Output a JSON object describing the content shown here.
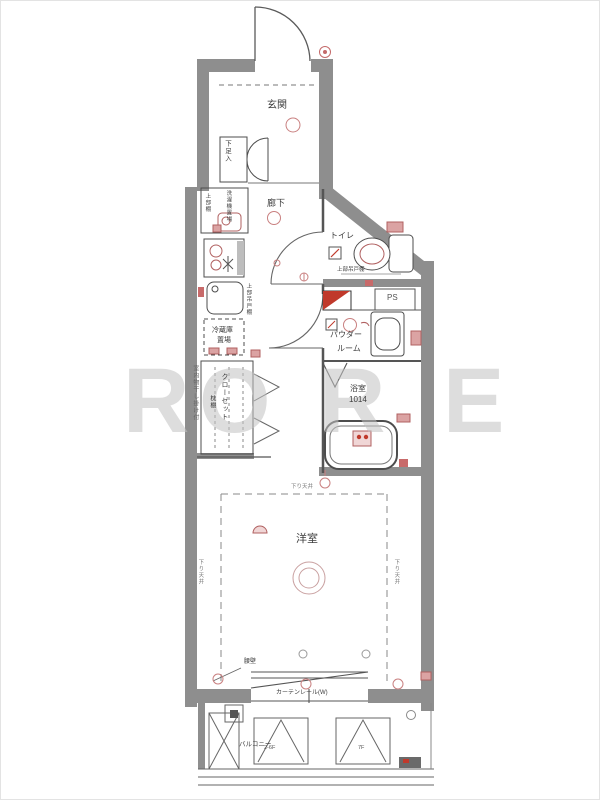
{
  "plan": {
    "entrance": {
      "label": "玄関"
    },
    "shoe_box": {
      "label": "下足入"
    },
    "hallway": {
      "label": "廊下"
    },
    "toilet": {
      "label": "トイレ",
      "upper_cabinet": "上部吊戸棚"
    },
    "ps": {
      "label": "PS"
    },
    "powder_room": {
      "line1": "パウダー",
      "line2": "ルーム"
    },
    "bathroom": {
      "label": "浴室",
      "size": "1014"
    },
    "kitchen": {
      "washer": "洗濯機置場",
      "washer_shelf": "上部棚",
      "upper_cabinet": "上部吊戸棚",
      "fridge_line1": "冷蔵庫",
      "fridge_line2": "置場"
    },
    "closet": {
      "label": "クローゼット",
      "shelf": "枕棚",
      "laundry_note": "室内物干し掛け付"
    },
    "room": {
      "label": "洋室",
      "lowered_ceiling_top": "下り天井",
      "lowered_ceiling_left": "下り天井",
      "lowered_ceiling_right": "下り天井",
      "waist_wall": "腰壁",
      "curtain_rail": "カーテンレール(W)"
    },
    "balcony": {
      "label": "バルコニー",
      "panel_a": "2-6F",
      "panel_b": "7F"
    }
  },
  "watermark": {
    "letters": [
      "R",
      "O",
      "R",
      "E"
    ]
  },
  "colors": {
    "wall": "#8e8e8e",
    "line": "#4d4d4d",
    "accent": "#c0392b",
    "accent_light": "#d98c8c"
  }
}
